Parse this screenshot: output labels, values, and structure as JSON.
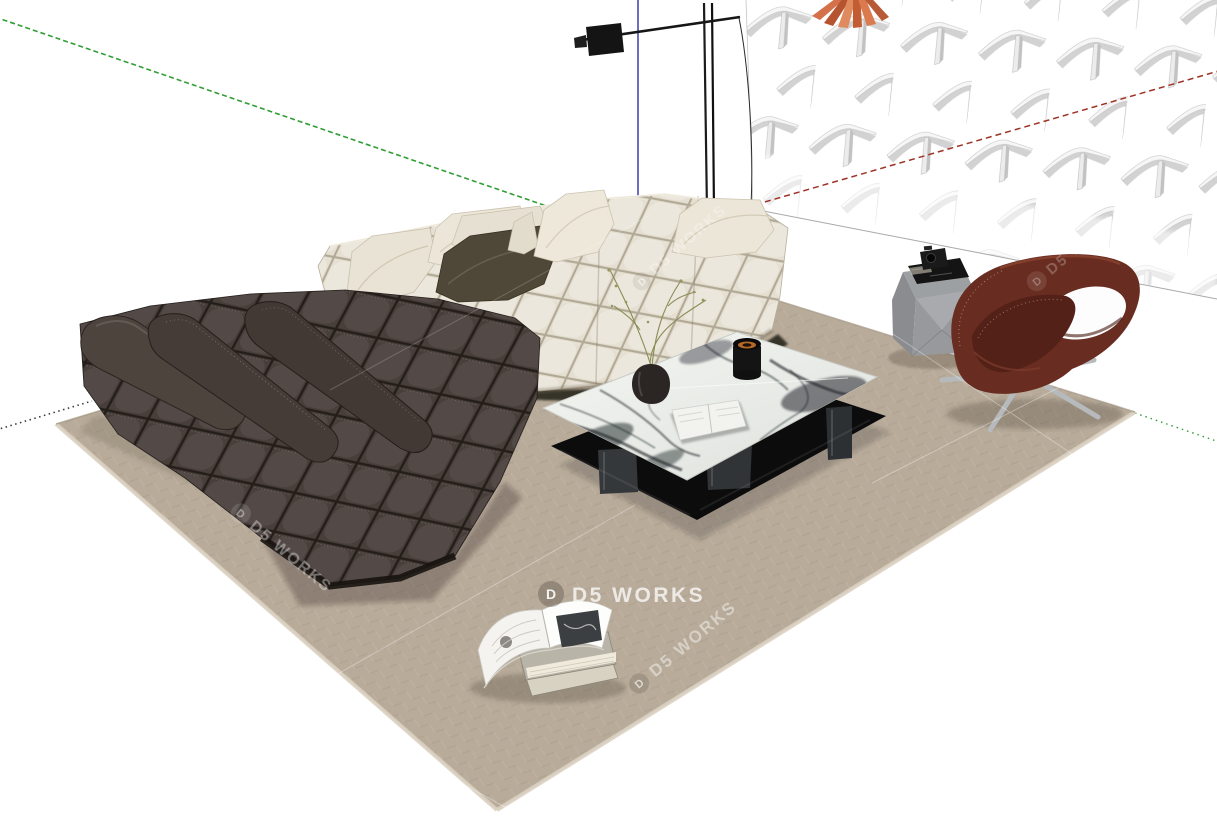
{
  "viewport": {
    "width": 1217,
    "height": 825,
    "background": "#ffffff"
  },
  "watermark": {
    "brand": "D5 WORKS",
    "logo_letter": "D"
  },
  "palette": {
    "axisGreen": "#2f9e33",
    "axisRed": "#9e3226",
    "axisBlue": "#3c3fae",
    "axisNeg": "#3a3a3a",
    "rug": "#b8ab9a",
    "rugEdge": "#dbd1c2",
    "creamSofa": "#e5dfd1",
    "creamShade": "#cfc7b4",
    "darkSofa": "#483e3a",
    "darkDeep": "#332b28",
    "tableBlack": "#0c0c0c",
    "marbleLight": "#eef0ec",
    "marbleVein": "#1c1f24",
    "chair": "#682c20",
    "chairSeat": "#532117",
    "chrome": "#b7babc",
    "sideTable": "#9da0a3",
    "bookCover": "#9e5a49",
    "plant": "#8a8c55",
    "orange": "#d4714a",
    "wallShadow": "#d2d2d2"
  }
}
